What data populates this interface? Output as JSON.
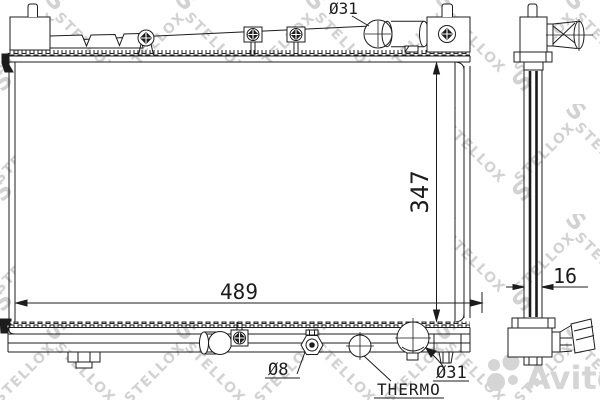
{
  "drawing": {
    "kind": "radiator-technical-drawing",
    "labels": {
      "inlet_diameter": "Ø31",
      "core_height": "347",
      "core_width": "489",
      "drain_diameter": "Ø8",
      "thermo": "THERMO",
      "outlet_diameter": "Ø31",
      "thickness": "16"
    }
  },
  "watermarks": {
    "brand": "STELLOX",
    "brand_initial": "S",
    "portal": "abcp",
    "marketplace": "Avito"
  },
  "colors": {
    "line": "#1c1c1c",
    "watermark": "#d2d2d2",
    "logo_gray": "#d5d5d5",
    "background": "#ffffff"
  }
}
